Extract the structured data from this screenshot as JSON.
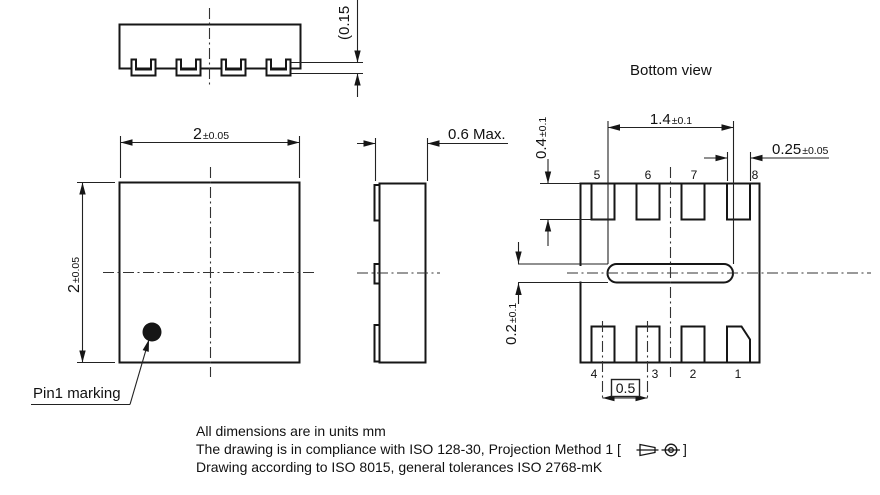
{
  "top_profile_view": {
    "standoff_dim": "(0.15"
  },
  "top_view": {
    "width_dim": {
      "main": "2",
      "tol": "±0.05"
    },
    "height_dim": {
      "main": "2",
      "tol": "±0.05"
    },
    "pin1_label": "Pin1 marking"
  },
  "side_view": {
    "thickness_dim": "0.6 Max."
  },
  "bottom_view": {
    "title": "Bottom view",
    "epad_length_dim": {
      "main": "1.4",
      "tol": "±0.1"
    },
    "pad_length_dim": {
      "main": "0.4",
      "tol": "±0.1"
    },
    "pad_width_dim": {
      "main": "0.25",
      "tol": "±0.05"
    },
    "epad_tab_dim": {
      "main": "0.2",
      "tol": "±0.1"
    },
    "pitch_dim": "0.5",
    "pin_numbers_top": [
      "5",
      "6",
      "7",
      "8"
    ],
    "pin_numbers_bottom": [
      "4",
      "3",
      "2",
      "1"
    ]
  },
  "notes": {
    "line1": "All dimensions are in units mm",
    "line2_prefix": "The drawing is in compliance with ISO 128-30, Projection Method 1 [",
    "line2_suffix": "]",
    "line3": "Drawing according to ISO 8015, general tolerances ISO 2768-mK"
  }
}
